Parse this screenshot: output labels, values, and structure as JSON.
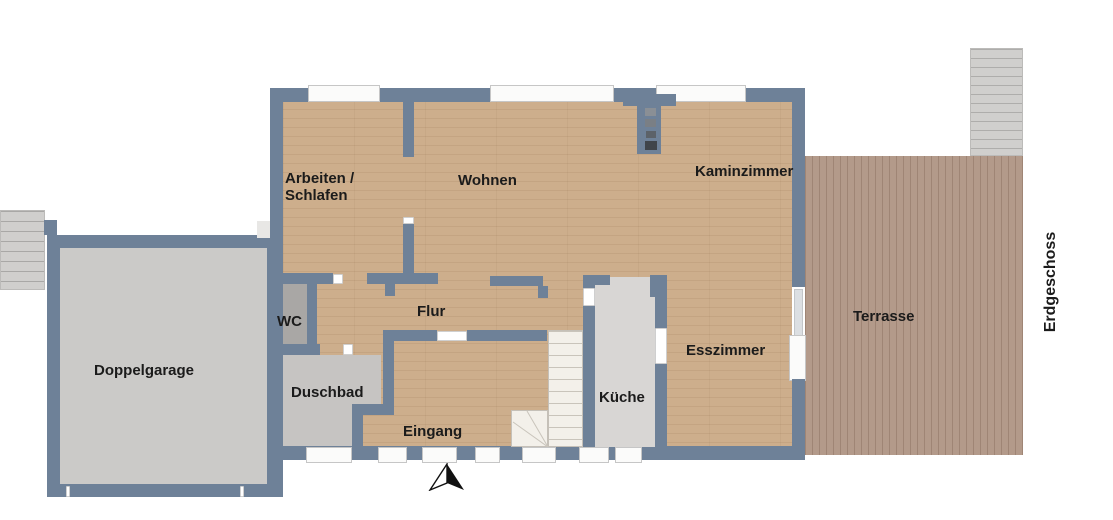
{
  "floor_plan": {
    "floor_label": "Erdgeschoss",
    "rooms": {
      "arbeiten_schlafen_line1": "Arbeiten /",
      "arbeiten_schlafen_line2": "Schlafen",
      "wohnen": "Wohnen",
      "kaminzimmer": "Kaminzimmer",
      "wc": "WC",
      "flur": "Flur",
      "duschbad": "Duschbad",
      "eingang": "Eingang",
      "kueche": "Küche",
      "esszimmer": "Esszimmer",
      "doppelgarage": "Doppelgarage",
      "terrasse": "Terrasse"
    },
    "colors": {
      "wall": "#6e8198",
      "wood_floor": "#cdae8c",
      "terrace_deck": "#b39a8a",
      "garage_floor": "#cbcac8",
      "wc_floor": "#a9a7a5",
      "bath_floor": "#c6c4c2",
      "kitchen_floor": "#d8d6d4",
      "stairs": "#d0cfcd",
      "label_text": "#1b1b1b"
    },
    "features": {
      "north_arrow": "north-arrow",
      "chimney": "chimney-with-flues",
      "stairs_interior": "winder-staircase",
      "stairs_exterior_left": "exterior-steps",
      "stairs_terrace": "terrace-steps"
    }
  }
}
